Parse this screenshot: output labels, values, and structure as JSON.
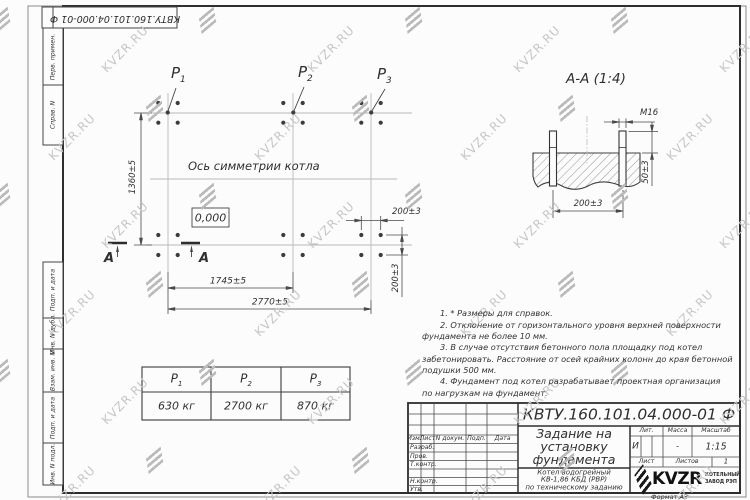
{
  "colors": {
    "line": "#3a3a3a",
    "axis": "#b8b8b8",
    "watermark_text": "#c6c6c6",
    "watermark_logo": "#bababa"
  },
  "watermark": {
    "text": "KVZR.RU"
  },
  "corner_box": {
    "doc_number": "КВТУ.160.101.04.000-01 Ф"
  },
  "margin_stamps": {
    "labels": [
      "Перв. примен.",
      "Справ. N",
      "Подп. и дата",
      "Инв. N дубл.",
      "Взам. инв. N",
      "Подп. и дата",
      "Инв. N подл."
    ]
  },
  "plan": {
    "point_labels": [
      {
        "base": "Р",
        "sub": "1"
      },
      {
        "base": "Р",
        "sub": "2"
      },
      {
        "base": "Р",
        "sub": "3"
      }
    ],
    "symmetry_axis_label": "Ось симметрии котла",
    "level_mark": "0,000",
    "section_letter": "А",
    "dim_height": "1360±5",
    "dim_span_inner": "1745±5",
    "dim_span_outer": "2770±5",
    "dim_bolt_x": "200±3",
    "dim_bolt_y": "200±3"
  },
  "section_view": {
    "title": "А-А (1:4)",
    "thread_label": "М16",
    "dim_protrusion": "50±3",
    "dim_spacing": "200±3"
  },
  "loads_table": {
    "headers": [
      {
        "base": "Р",
        "sub": "1"
      },
      {
        "base": "Р",
        "sub": "2"
      },
      {
        "base": "Р",
        "sub": "3"
      }
    ],
    "values": [
      "630 кг",
      "2700 кг",
      "870 кг"
    ]
  },
  "notes": {
    "lines": [
      {
        "text": "1. * Размеры для справок.",
        "indent": true
      },
      {
        "text": "2. Отклонение от горизонтального уровня верхней поверхности",
        "indent": true
      },
      {
        "text": "фундамента не более 10 мм.",
        "indent": false
      },
      {
        "text": "3. В случае отсутствия бетонного пола площадку под котел",
        "indent": true
      },
      {
        "text": "забетонировать. Расстояние от осей крайних колонн до края бетонной",
        "indent": false
      },
      {
        "text": "подушки 500 мм.",
        "indent": false
      },
      {
        "text": "4. Фундамент под котел разрабатывает проектная организация",
        "indent": true
      },
      {
        "text": "по нагрузкам на фундамент.",
        "indent": false
      }
    ]
  },
  "title_block": {
    "doc_number": "КВТУ.160.101.04.000-01 Ф",
    "title_lines": [
      "Задание на",
      "установку",
      "фундамента"
    ],
    "product_lines": [
      "Котел водогрейный",
      "КВ-1,86 КБД (РВР)",
      "по техническому заданию"
    ],
    "header_cells": [
      "Изм.",
      "Лист",
      "N докум.",
      "Подп.",
      "Дата"
    ],
    "signature_rows": [
      "Разраб.",
      "Пров.",
      "Т.контр.",
      "Н.контр.",
      "Утв."
    ],
    "lit_header": "Лит.",
    "mass_header": "Масса",
    "scale_header": "Масштаб",
    "lit_value": "И",
    "mass_value": "-",
    "scale_value": "1:15",
    "sheet_label": "Лист",
    "sheets_label": "Листов",
    "sheets_value": "1",
    "logo_text": "KVZR",
    "logo_caption_lines": [
      "КОТЕЛЬНЫЙ",
      "ЗАВОД РЭП"
    ],
    "format_label": "Формат А3"
  }
}
